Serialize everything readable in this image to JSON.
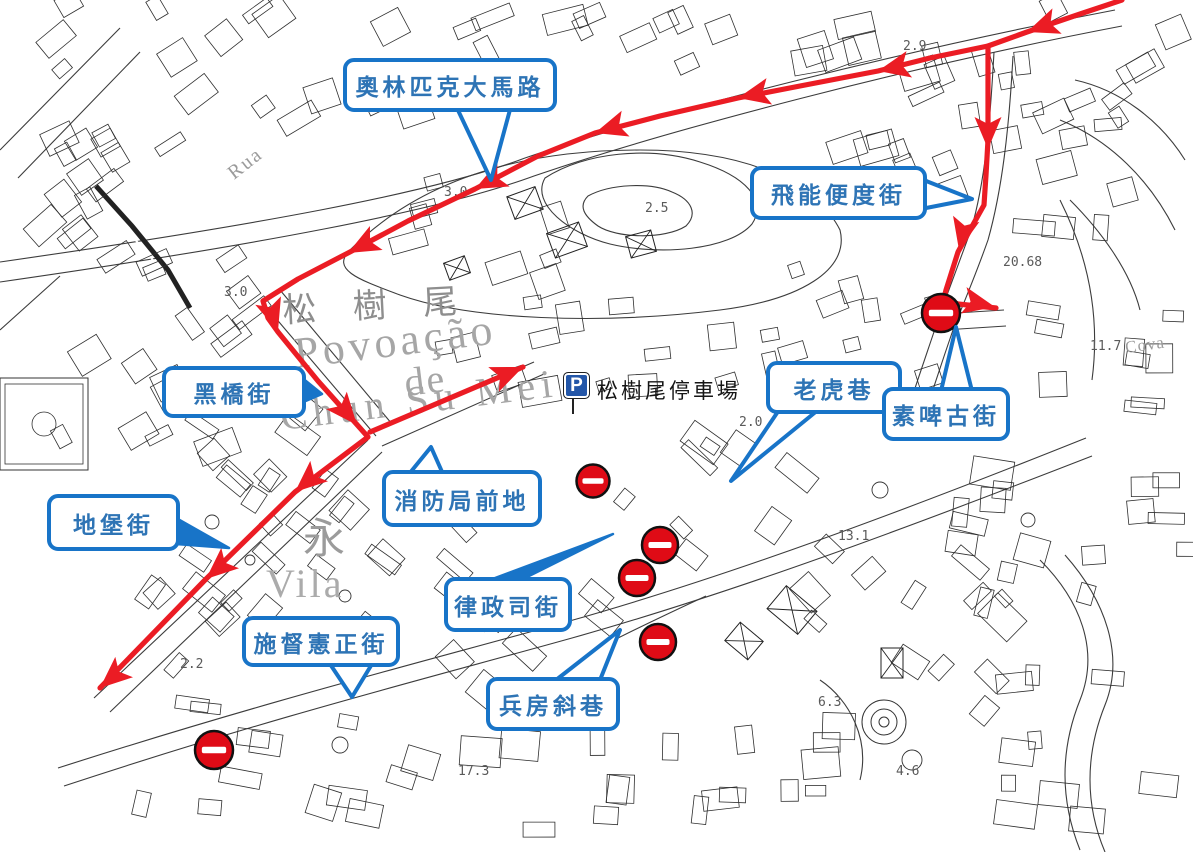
{
  "map": {
    "type": "traffic-diversion-map",
    "colors": {
      "callout_border": "#1874C8",
      "callout_text": "#2E74B5",
      "route_red": "#EB1C24",
      "sign_red": "#DF0B16",
      "parking_blue": "#2356A8"
    },
    "parking": {
      "icon": "parking-icon",
      "label": "松樹尾停車場"
    },
    "background_labels": [
      {
        "text": "松  樹  尾",
        "x": 283,
        "y": 322,
        "size": 34,
        "rotate": -3,
        "ls": 14,
        "color": "#8e8e8e"
      },
      {
        "text": "Povoação",
        "x": 296,
        "y": 368,
        "size": 44,
        "rotate": -7,
        "ls": 4,
        "color": "#a6a6a6"
      },
      {
        "text": "de",
        "x": 406,
        "y": 396,
        "size": 40,
        "rotate": -7,
        "ls": 2,
        "color": "#a6a6a6"
      },
      {
        "text": "Chun Su Mei",
        "x": 282,
        "y": 430,
        "size": 40,
        "rotate": -7,
        "ls": 6,
        "color": "#a6a6a6"
      },
      {
        "text": "永",
        "x": 303,
        "y": 553,
        "size": 42,
        "rotate": 0,
        "ls": 0,
        "color": "#9b9b9b"
      },
      {
        "text": "Vila",
        "x": 266,
        "y": 597,
        "size": 40,
        "rotate": 0,
        "ls": 3,
        "color": "#ababab"
      },
      {
        "text": "Rua",
        "x": 234,
        "y": 180,
        "size": 20,
        "rotate": -38,
        "ls": 2,
        "color": "#9b9b9b"
      },
      {
        "text": "Cova",
        "x": 1126,
        "y": 353,
        "size": 17,
        "rotate": -8,
        "ls": 1,
        "color": "#9b9b9b"
      }
    ],
    "elevation_marks": [
      {
        "text": "2.9",
        "x": 903,
        "y": 50
      },
      {
        "text": "3.0",
        "x": 444,
        "y": 196
      },
      {
        "text": "3.0",
        "x": 224,
        "y": 296
      },
      {
        "text": "2.5",
        "x": 645,
        "y": 212
      },
      {
        "text": "2.0",
        "x": 739,
        "y": 426
      },
      {
        "text": "20.68",
        "x": 1003,
        "y": 266
      },
      {
        "text": "11.7",
        "x": 1090,
        "y": 350
      },
      {
        "text": "13.1",
        "x": 838,
        "y": 540
      },
      {
        "text": "6.3",
        "x": 818,
        "y": 706
      },
      {
        "text": "4.6",
        "x": 896,
        "y": 775
      },
      {
        "text": "17.3",
        "x": 458,
        "y": 775
      },
      {
        "text": "2.2",
        "x": 180,
        "y": 668
      }
    ],
    "callouts": [
      {
        "id": "olympic-avenue",
        "label": "奧林匹克大馬路",
        "box": {
          "x": 343,
          "y": 58,
          "w": 214,
          "h": 54
        },
        "pointer": {
          "base": [
            [
              456,
              106
            ],
            [
              511,
              106
            ]
          ],
          "tip": [
            491,
            180
          ],
          "filled": false
        }
      },
      {
        "id": "feineng-biandu-street",
        "label": "飛能便度街",
        "box": {
          "x": 750,
          "y": 166,
          "w": 177,
          "h": 54
        },
        "pointer": {
          "base": [
            [
              921,
              179
            ],
            [
              921,
              209
            ]
          ],
          "tip": [
            972,
            199
          ],
          "filled": false
        }
      },
      {
        "id": "heiqiao-street",
        "label": "黑橋街",
        "box": {
          "x": 162,
          "y": 366,
          "w": 144,
          "h": 52
        },
        "pointer": {
          "base": [
            [
              301,
              377
            ],
            [
              301,
              403
            ]
          ],
          "tip": [
            322,
            394
          ],
          "filled": true
        }
      },
      {
        "id": "laohu-lane",
        "label": "老虎巷",
        "box": {
          "x": 766,
          "y": 361,
          "w": 136,
          "h": 53
        },
        "pointer": {
          "base": [
            [
              779,
              410
            ],
            [
              818,
              410
            ]
          ],
          "tip": [
            731,
            481
          ],
          "filled": false
        }
      },
      {
        "id": "subigu-street",
        "label": "素啤古街",
        "box": {
          "x": 882,
          "y": 387,
          "w": 128,
          "h": 54
        },
        "pointer": {
          "base": [
            [
              941,
              391
            ],
            [
              972,
              391
            ]
          ],
          "tip": [
            956,
            327
          ],
          "filled": false
        }
      },
      {
        "id": "xiaofangju-qiandi",
        "label": "消防局前地",
        "box": {
          "x": 382,
          "y": 470,
          "w": 160,
          "h": 57
        },
        "pointer": {
          "base": [
            [
              409,
              474
            ],
            [
              443,
              474
            ]
          ],
          "tip": [
            431,
            447
          ],
          "filled": false
        }
      },
      {
        "id": "dibao-street",
        "label": "地堡街",
        "box": {
          "x": 47,
          "y": 494,
          "w": 133,
          "h": 57
        },
        "pointer": {
          "base": [
            [
              176,
              518
            ],
            [
              176,
              544
            ]
          ],
          "tip": [
            229,
            548
          ],
          "filled": true
        }
      },
      {
        "id": "lvzhengsi-street",
        "label": "律政司街",
        "box": {
          "x": 444,
          "y": 577,
          "w": 128,
          "h": 55
        },
        "pointer": {
          "base": [
            [
              487,
              581
            ],
            [
              519,
              581
            ]
          ],
          "tip": [
            613,
            534
          ],
          "filled": true
        }
      },
      {
        "id": "shiduxian-zhengjie",
        "label": "施督憲正街",
        "box": {
          "x": 242,
          "y": 616,
          "w": 158,
          "h": 51
        },
        "pointer": {
          "base": [
            [
              330,
              664
            ],
            [
              372,
              664
            ]
          ],
          "tip": [
            352,
            697
          ],
          "filled": false
        }
      },
      {
        "id": "bingfang-xiexiang",
        "label": "兵房斜巷",
        "box": {
          "x": 486,
          "y": 677,
          "w": 134,
          "h": 54
        },
        "pointer": {
          "base": [
            [
              556,
              680
            ],
            [
              600,
              680
            ]
          ],
          "tip": [
            620,
            630
          ],
          "filled": false
        }
      }
    ],
    "route": {
      "color": "#EB1C24",
      "segments": [
        [
          [
            1122,
            0
          ],
          [
            1080,
            14
          ],
          [
            1027,
            32
          ],
          [
            988,
            46
          ],
          [
            930,
            58
          ],
          [
            878,
            71
          ],
          [
            800,
            86
          ],
          [
            738,
            98
          ],
          [
            660,
            116
          ],
          [
            595,
            133
          ],
          [
            538,
            156
          ],
          [
            475,
            189
          ],
          [
            408,
            221
          ],
          [
            348,
            253
          ],
          [
            298,
            279
          ],
          [
            263,
            301
          ],
          [
            268,
            318
          ],
          [
            278,
            332
          ],
          [
            318,
            381
          ],
          [
            360,
            428
          ],
          [
            368,
            437
          ],
          [
            295,
            492
          ],
          [
            206,
            579
          ],
          [
            100,
            688
          ]
        ],
        [
          [
            988,
            46
          ],
          [
            988,
            140
          ],
          [
            986,
            175
          ],
          [
            984,
            205
          ],
          [
            970,
            230
          ],
          [
            958,
            252
          ],
          [
            946,
            290
          ],
          [
            944,
            299
          ],
          [
            958,
            304
          ],
          [
            996,
            308
          ]
        ],
        [
          [
            370,
            432
          ],
          [
            523,
            367
          ]
        ]
      ],
      "arrows": [
        [
          1027,
          32,
          160
        ],
        [
          878,
          71,
          168
        ],
        [
          738,
          98,
          168
        ],
        [
          595,
          133,
          163
        ],
        [
          475,
          189,
          153
        ],
        [
          348,
          253,
          152
        ],
        [
          278,
          331,
          72
        ],
        [
          357,
          425,
          50
        ],
        [
          295,
          492,
          139
        ],
        [
          206,
          579,
          139
        ],
        [
          100,
          688,
          139
        ],
        [
          988,
          149,
          90
        ],
        [
          959,
          250,
          103
        ],
        [
          995,
          307,
          12
        ],
        [
          523,
          367,
          -23
        ]
      ]
    },
    "no_entry_signs": [
      [
        941,
        313,
        38
      ],
      [
        593,
        481,
        33
      ],
      [
        660,
        545,
        36
      ],
      [
        637,
        578,
        36
      ],
      [
        658,
        642,
        36
      ],
      [
        214,
        750,
        38
      ]
    ]
  }
}
